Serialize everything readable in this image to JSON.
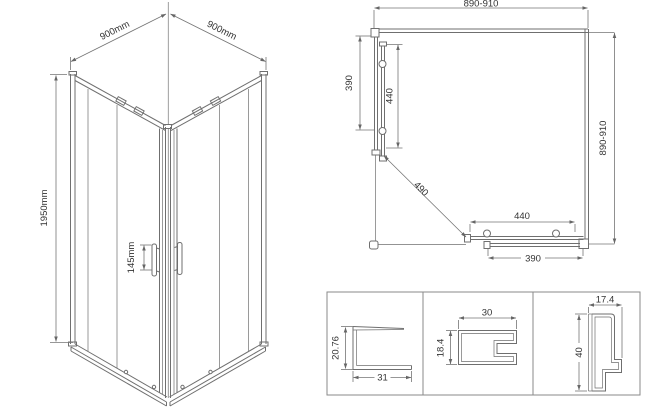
{
  "iso_view": {
    "top_width_left": "900mm",
    "top_width_right": "900mm",
    "height": "1950mm",
    "handle_spacing": "145mm"
  },
  "plan_view": {
    "overall_width": "890-910",
    "overall_depth": "890-910",
    "side_fixed_panel": "390",
    "side_door_panel": "440",
    "diagonal_opening": "490",
    "front_door_panel": "440",
    "front_fixed_panel": "390"
  },
  "profile_details": {
    "u_channel": {
      "height": "20.76",
      "width": "31"
    },
    "frame_section": {
      "width": "30",
      "height": "18.4"
    },
    "door_rail": {
      "width": "17.4",
      "height": "40"
    }
  },
  "colors": {
    "line": "#6f6f6f",
    "dimension": "#757575",
    "text": "#333333",
    "background": "#ffffff"
  }
}
